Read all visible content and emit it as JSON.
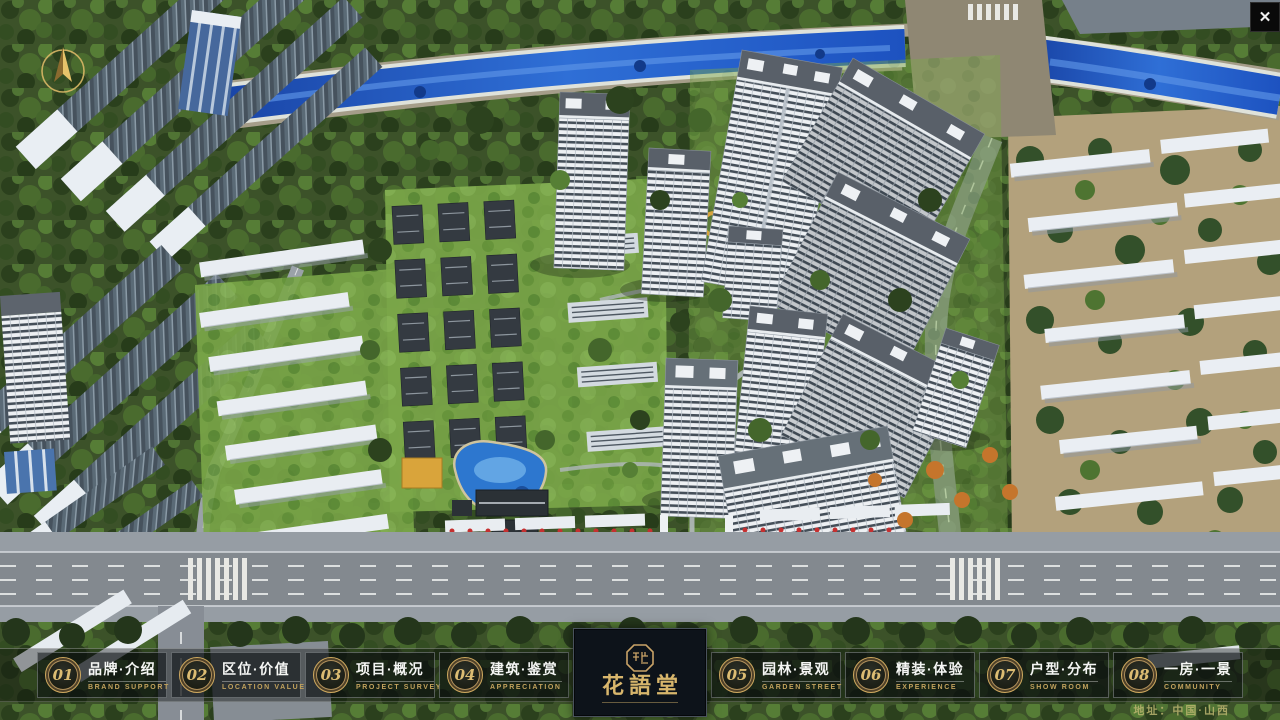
{
  "window": {
    "close_glyph": "✕"
  },
  "nav": {
    "items": [
      {
        "num": "01",
        "label": "品牌·介绍",
        "sub": "BRAND SUPPORT"
      },
      {
        "num": "02",
        "label": "区位·价值",
        "sub": "LOCATION VALUE"
      },
      {
        "num": "03",
        "label": "项目·概况",
        "sub": "PROJECT SURVEY"
      },
      {
        "num": "04",
        "label": "建筑·鉴赏",
        "sub": "APPRECIATION"
      },
      {
        "num": "05",
        "label": "园林·景观",
        "sub": "GARDEN STREET"
      },
      {
        "num": "06",
        "label": "精装·体验",
        "sub": "EXPERIENCE"
      },
      {
        "num": "07",
        "label": "户型·分布",
        "sub": "SHOW ROOM"
      },
      {
        "num": "08",
        "label": "一房·一景",
        "sub": "COMMUNITY"
      }
    ],
    "logo": {
      "title": "花語堂"
    },
    "address": "地址：中国·山西"
  },
  "colors": {
    "accent_gold": "#c9a367",
    "panel_dark": "#0d131a",
    "label_white": "#f5f6f4",
    "sub_gold": "#bfa05e",
    "river_blue": "#1d52c0",
    "address_olive": "#b0aa60"
  }
}
